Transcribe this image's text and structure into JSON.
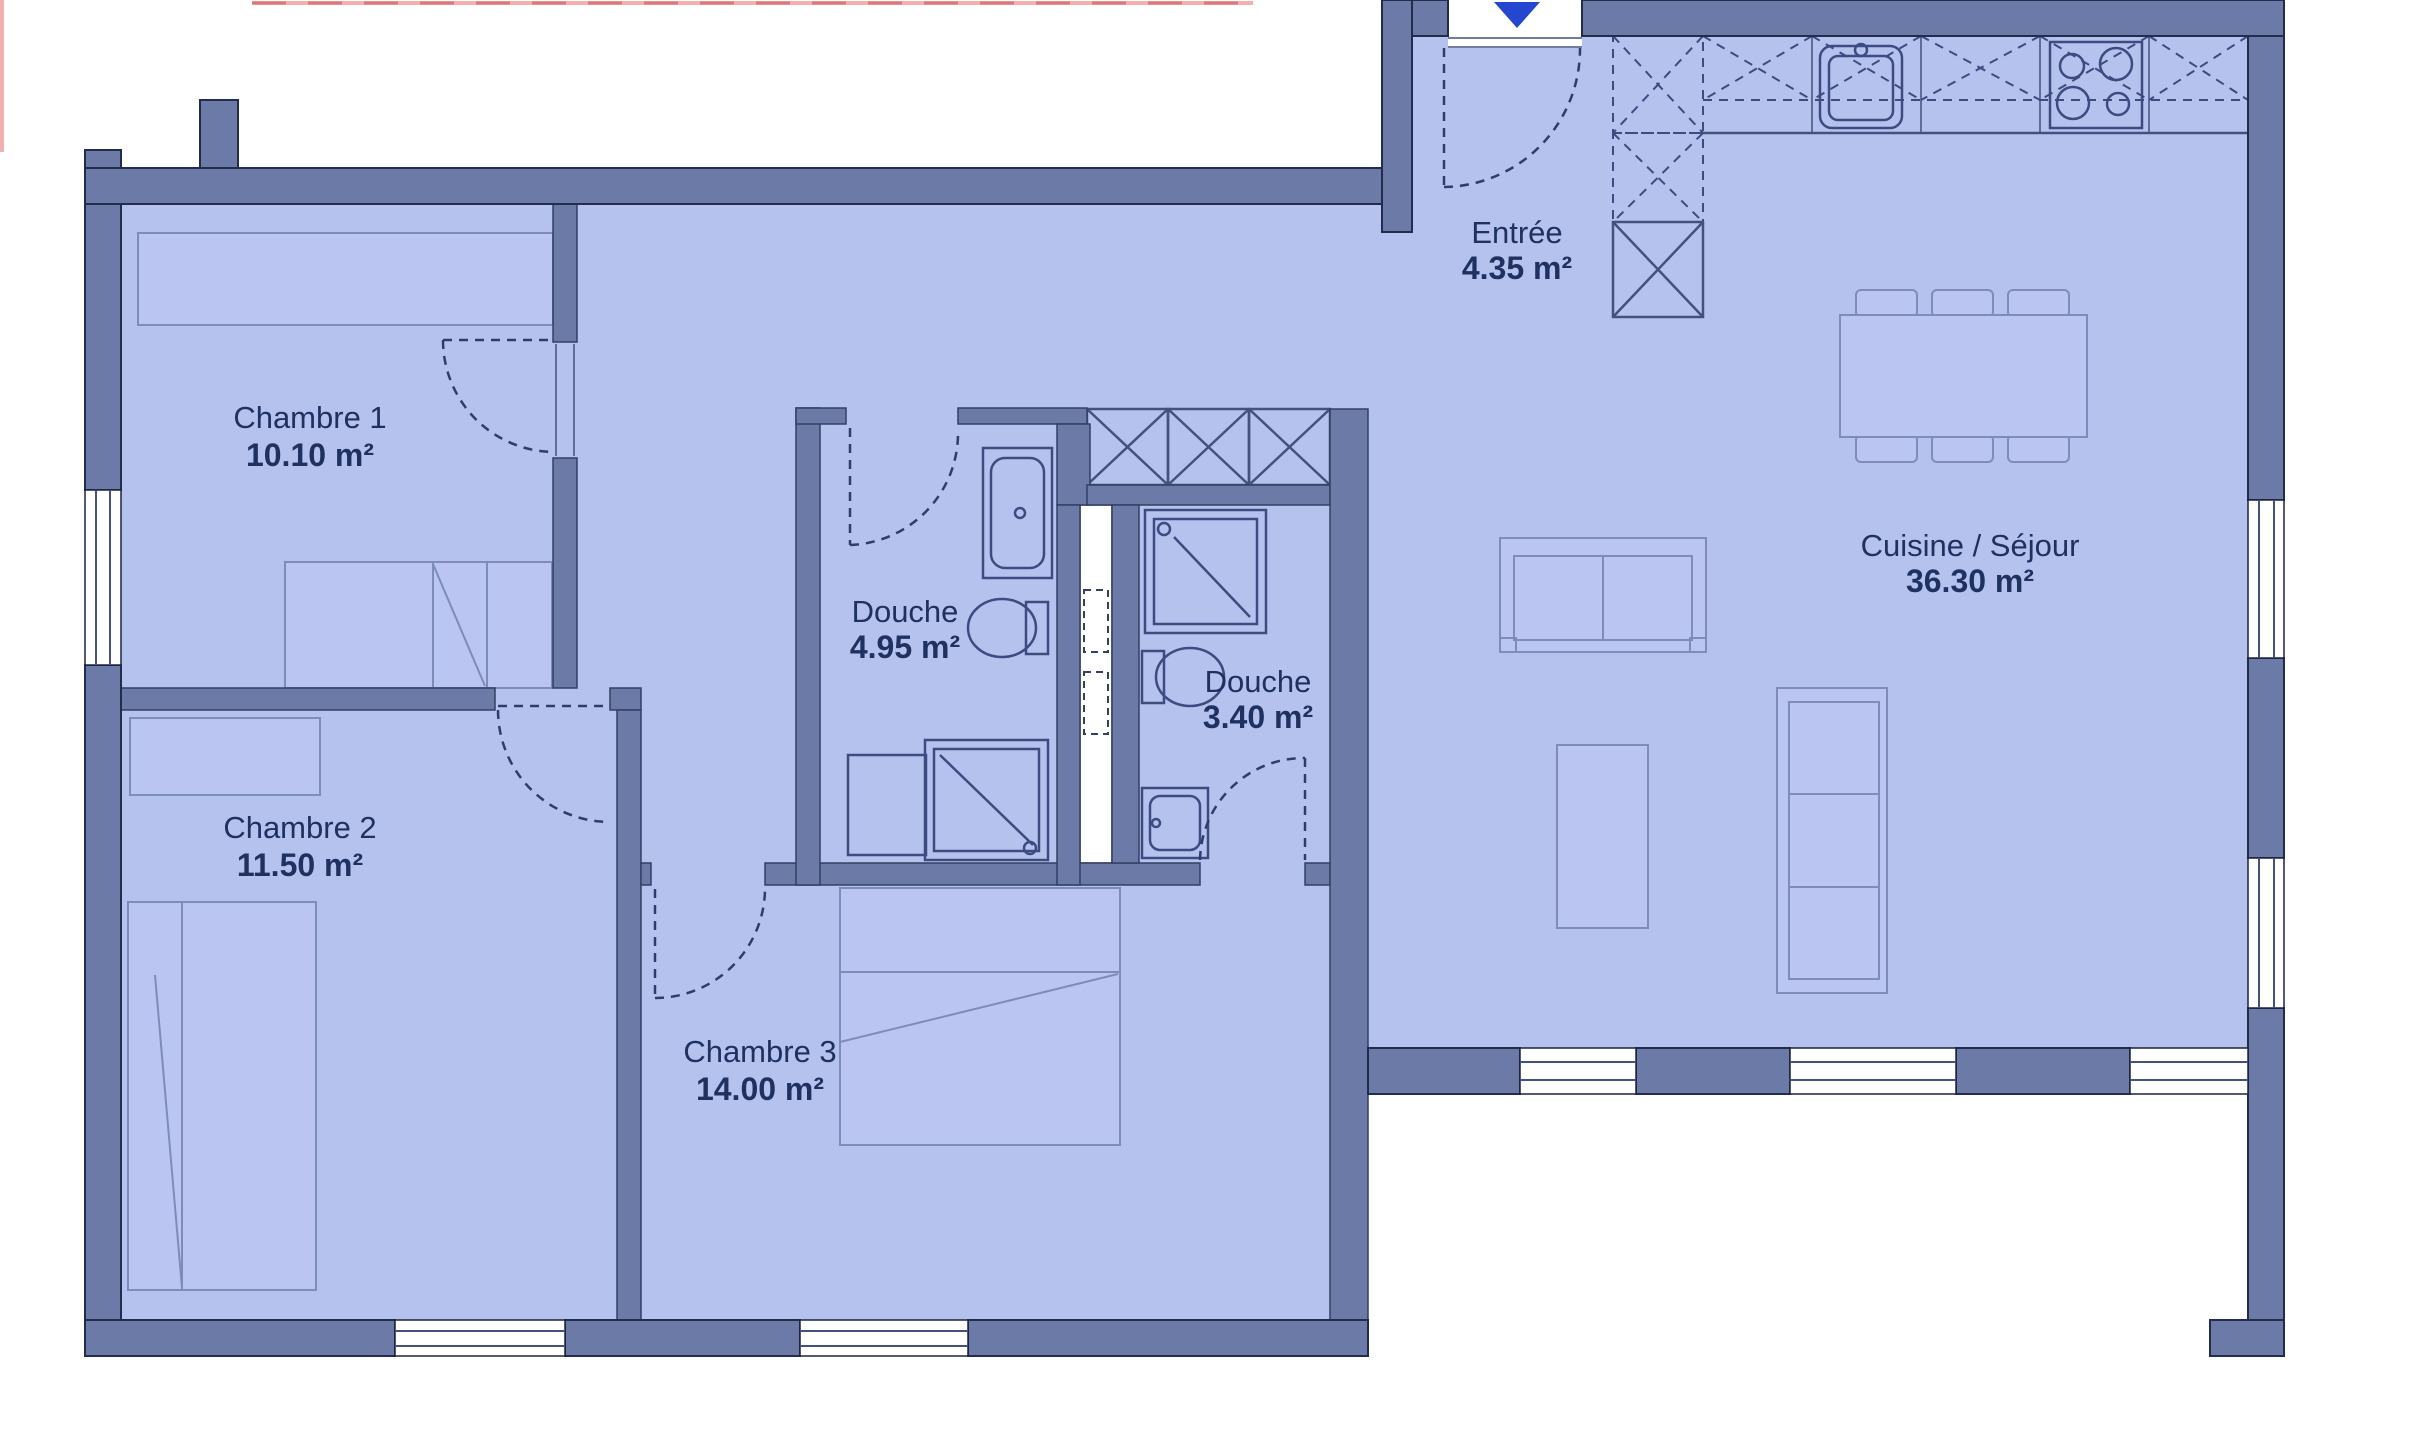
{
  "rooms": {
    "chambre1": {
      "name": "Chambre 1",
      "area": "10.10 m²"
    },
    "chambre2": {
      "name": "Chambre 2",
      "area": "11.50 m²"
    },
    "chambre3": {
      "name": "Chambre 3",
      "area": "14.00 m²"
    },
    "douche1": {
      "name": "Douche",
      "area": "4.95 m²"
    },
    "douche2": {
      "name": "Douche",
      "area": "3.40 m²"
    },
    "entree": {
      "name": "Entrée",
      "area": "4.35 m²"
    },
    "cuisine": {
      "name": "Cuisine / Séjour",
      "area": "36.30 m²"
    }
  },
  "colors": {
    "floor": "#b6c2ee",
    "wall": "#6b7aa6",
    "fixture_line": "#3c4c80",
    "text": "#1e3160",
    "red_marker": "#f2b0b0",
    "entrance_arrow": "#2547d0"
  },
  "icons": {
    "entrance_arrow": "down-arrow"
  }
}
